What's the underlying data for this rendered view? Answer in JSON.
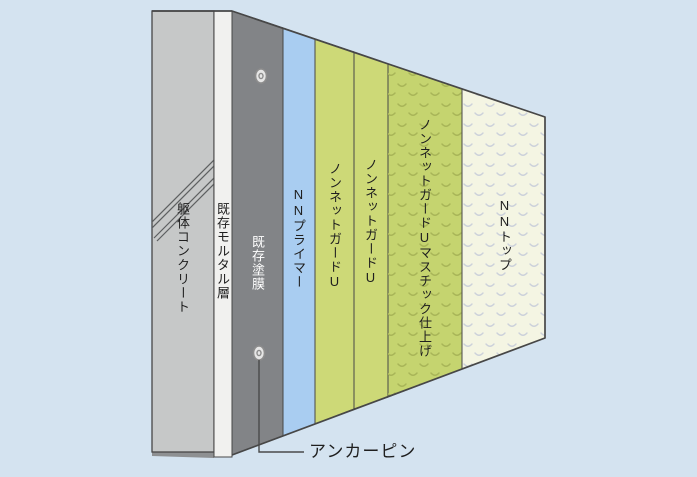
{
  "diagram": {
    "layers": [
      {
        "id": "concrete",
        "label": "躯体コンクリート"
      },
      {
        "id": "mortar",
        "label": "既存モルタル層"
      },
      {
        "id": "coating",
        "label": "既存塗膜"
      },
      {
        "id": "primer",
        "label": "NNプライマー"
      },
      {
        "id": "guard1",
        "label": "ノンネットガードU"
      },
      {
        "id": "guard2",
        "label": "ノンネットガードU"
      },
      {
        "id": "mastic",
        "label": "ノンネットガードUマスチック仕上げ"
      },
      {
        "id": "nntop",
        "label": "NNトップ"
      }
    ],
    "annotation": {
      "label": "アンカーピン"
    },
    "pins": {
      "icon": "anchor-pin",
      "count": 2
    }
  },
  "colors": {
    "background": "#d4e3f0",
    "outline": "#474747",
    "concrete": "#c6c8c8",
    "concrete_shadow": "#8e9092",
    "hatch_line": "#5d5f60",
    "mortar": "#f1f1ef",
    "coating": "#828487",
    "primer": "#a9cdf1",
    "guard": "#cdd977",
    "mastic": "#c5d46f",
    "mastic_chevron": "#a8b558",
    "nntop": "#f4f5e3",
    "nntop_chevron": "#ccd1da",
    "pin_fill": "#e6e6e6",
    "pin_stroke": "#8d8d8d",
    "callout_line": "#4a4a4a",
    "text_dark": "#1f1f1f",
    "text_light": "#ffffff"
  }
}
